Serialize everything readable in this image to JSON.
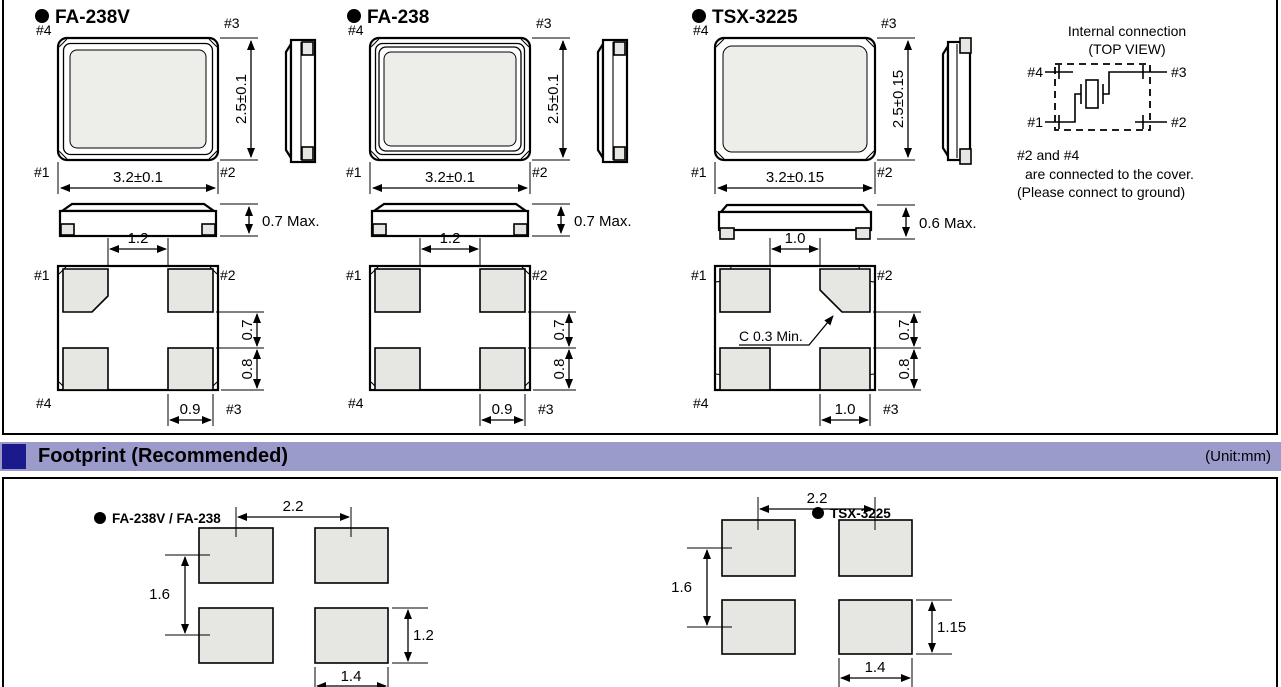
{
  "colors": {
    "header_bar": "#9A9BCB",
    "header_square": "#1B1A8D",
    "pad_fill": "#E6E6E2",
    "lid_fill": "#EDEDE9"
  },
  "packages": [
    {
      "name": "FA-238V",
      "top_view": {
        "pin_tl": "#4",
        "pin_tr": "#3",
        "pin_bl": "#1",
        "pin_br": "#2",
        "width": "3.2±0.1",
        "height": "2.5±0.1"
      },
      "profile": {
        "thickness": "0.7 Max."
      },
      "bottom_view": {
        "pin_tl": "#1",
        "pin_tr": "#2",
        "pin_bl": "#4",
        "pin_br": "#3",
        "top_gap": "1.2",
        "gap": "0.7",
        "pad_h": "0.8",
        "pad_w": "0.9"
      }
    },
    {
      "name": "FA-238",
      "top_view": {
        "pin_tl": "#4",
        "pin_tr": "#3",
        "pin_bl": "#1",
        "pin_br": "#2",
        "width": "3.2±0.1",
        "height": "2.5±0.1"
      },
      "profile": {
        "thickness": "0.7 Max."
      },
      "bottom_view": {
        "pin_tl": "#1",
        "pin_tr": "#2",
        "pin_bl": "#4",
        "pin_br": "#3",
        "top_gap": "1.2",
        "gap": "0.7",
        "pad_h": "0.8",
        "pad_w": "0.9"
      }
    },
    {
      "name": "TSX-3225",
      "top_view": {
        "pin_tl": "#4",
        "pin_tr": "#3",
        "pin_bl": "#1",
        "pin_br": "#2",
        "width": "3.2±0.15",
        "height": "2.5±0.15"
      },
      "profile": {
        "thickness": "0.6 Max."
      },
      "bottom_view": {
        "pin_tl": "#1",
        "pin_tr": "#2",
        "pin_bl": "#4",
        "pin_br": "#3",
        "top_gap": "1.0",
        "gap": "0.7",
        "pad_h": "0.8",
        "pad_w": "1.0",
        "chamfer": "C 0.3 Min."
      }
    }
  ],
  "internal": {
    "title1": "Internal connection",
    "title2": "(TOP VIEW)",
    "pin_tl": "#4",
    "pin_tr": "#3",
    "pin_bl": "#1",
    "pin_br": "#2",
    "note1": "#2 and #4",
    "note2": "are connected to the cover.",
    "note3": "(Please connect to ground)"
  },
  "footprint": {
    "header": {
      "title": "Footprint (Recommended)",
      "unit": "(Unit:mm)"
    },
    "items": [
      {
        "label": "FA-238V / FA-238",
        "h_pitch": "2.2",
        "v_pitch": "1.6",
        "pad_h": "1.2",
        "pad_w": "1.4"
      },
      {
        "label": "TSX-3225",
        "h_pitch": "2.2",
        "v_pitch": "1.6",
        "pad_h": "1.15",
        "pad_w": "1.4"
      }
    ]
  }
}
